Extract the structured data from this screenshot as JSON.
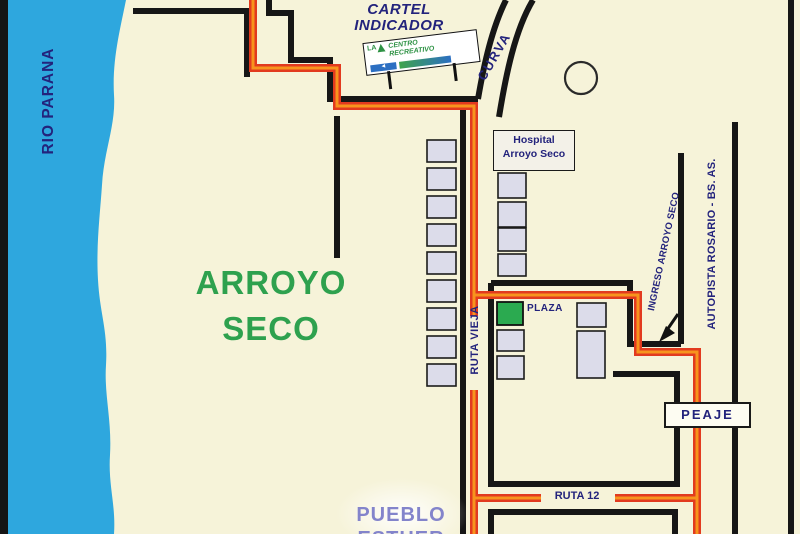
{
  "title": {
    "line1": "ARROYO",
    "line2": "SECO"
  },
  "river": {
    "label": "RIO PARANA"
  },
  "cartel": {
    "line1": "CARTEL",
    "line2": "INDICADOR"
  },
  "billboard": {
    "logo": "LA",
    "line1": "CENTRO",
    "line2": "RECREATIVO",
    "arrow": "◄"
  },
  "labels": {
    "curva": "CURVA",
    "hospital_line1": "Hospital",
    "hospital_line2": "Arroyo Seco",
    "plaza": "PLAZA",
    "ruta_vieja": "RUTA VIEJA",
    "ingreso": "INGRESO ARROYO SECO",
    "autopista": "AUTOPISTA ROSARIO - BS. AS.",
    "peaje": "PEAJE",
    "ruta12": "RUTA 12",
    "pueblo_line1": "PUEBLO",
    "pueblo_line2": "ESTHER"
  },
  "colors": {
    "background": "#F6F3D9",
    "river_blue": "#2EA7DE",
    "road_black": "#161616",
    "route_red": "#E23A1F",
    "route_orange": "#F7941D",
    "plaza_green": "#2BAA50",
    "title_green": "#2EA14E",
    "text_navy": "#23237C",
    "pueblo_purple": "#8384CB",
    "block_fill": "#DCDCEA",
    "sign_white": "#FDFCF2"
  }
}
